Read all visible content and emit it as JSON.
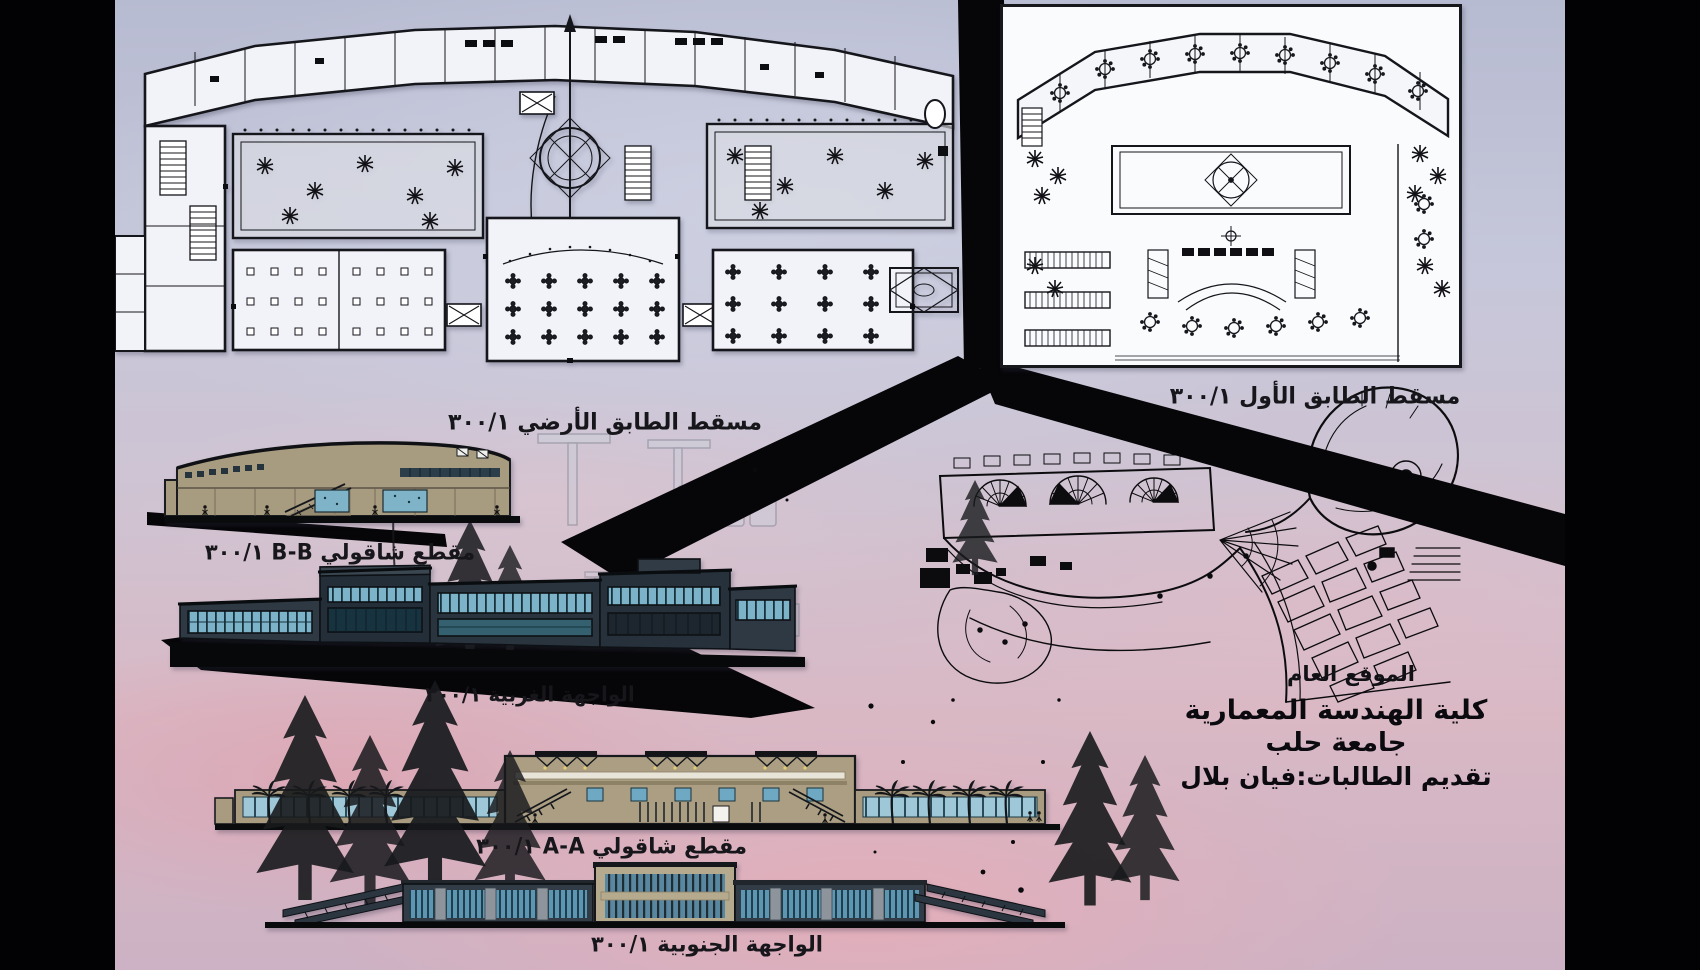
{
  "board": {
    "captions": {
      "ground_floor_plan": "مسقط الطابق الأرضي ٣٠٠/١",
      "first_floor_plan": "مسقط الطابق الأول ٣٠٠/١",
      "section_bb": "مقطع شاقولي B-B ٣٠٠/١",
      "west_elevation": "الواجهة الغربية ٣٠٠/١",
      "section_aa": "مقطع شاقولي A-A ٣٠٠/١",
      "south_elevation": "الواجهة الجنوبية ٣٠٠/١",
      "site_plan": "الموقع العام"
    },
    "title_block": {
      "faculty": "كلية الهندسة المعمارية",
      "university": "جامعة حلب",
      "presented_by": "تقديم الطالبات:فيان بلال"
    },
    "colors": {
      "sky_top": "#b7bbd1",
      "sky_pink": "#e7adb8",
      "ink_black": "#060608",
      "facade_tan": "#a89b7f",
      "glass_blue": "#74aec6",
      "steel_dark": "#2c3640",
      "plan_paper": "#f2f3f8"
    }
  }
}
